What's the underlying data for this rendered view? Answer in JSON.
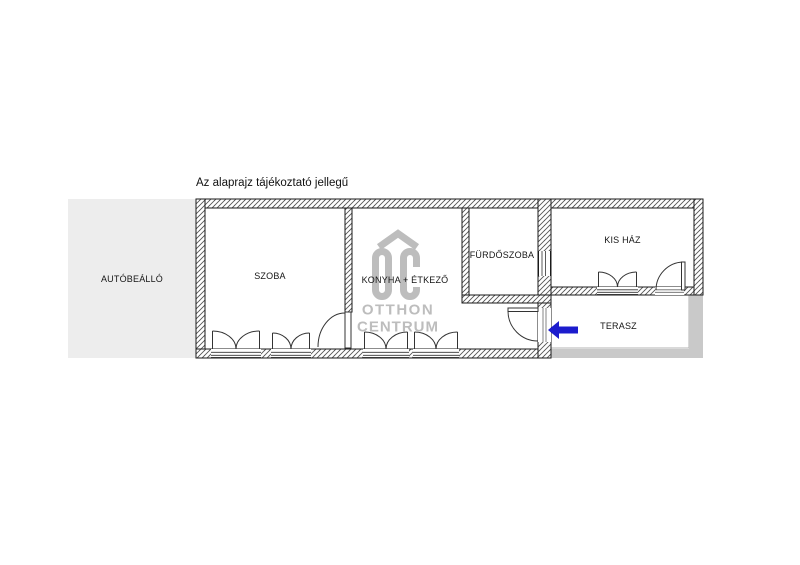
{
  "title": "Az alaprajz tájékoztató jellegű",
  "watermark": {
    "letters": "OC",
    "line1": "OTTHON",
    "line2": "CENTRUM",
    "color": "#bdbdbd"
  },
  "rooms": {
    "carport": {
      "label": "AUTÓBEÁLLÓ"
    },
    "room": {
      "label": "SZOBA"
    },
    "kitchen": {
      "label": "KONYHA + ÉTKEZŐ"
    },
    "bathroom": {
      "label": "FÜRDŐSZOBA"
    },
    "small_house": {
      "label": "KIS HÁZ"
    },
    "terrace": {
      "label": "TERASZ"
    }
  },
  "colors": {
    "carport_fill": "#ededed",
    "terrace_border": "#c9c9c9",
    "terrace_outline": "#b3b3b3",
    "arrow_blue": "#1c1ccd",
    "watermark_gray": "#bdbdbd",
    "wall_line": "#1a1a1a",
    "hatch_line": "#555555"
  }
}
